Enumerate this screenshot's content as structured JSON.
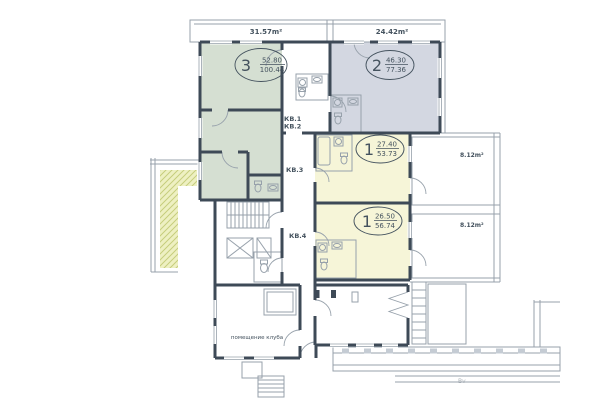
{
  "plan": {
    "watermark": "Bv",
    "terraces": {
      "left": "31.57m²",
      "right": "24.42m²"
    },
    "balconies": {
      "upper": "8.12m²",
      "lower": "8.12m²"
    },
    "units": {
      "kv1": "КВ.1",
      "kv2": "КВ.2",
      "kv3": "КВ.3",
      "kv4": "КВ.4"
    },
    "rooms": {
      "club": "помещение клуба"
    },
    "apartments": {
      "apt3": {
        "rooms": "3",
        "area1": "52.80",
        "area2": "100.44"
      },
      "apt2": {
        "rooms": "2",
        "area1": "46.30",
        "area2": "77.36"
      },
      "apt1a": {
        "rooms": "1",
        "area1": "27.40",
        "area2": "53.73"
      },
      "apt1b": {
        "rooms": "1",
        "area1": "26.50",
        "area2": "56.74"
      }
    },
    "colors": {
      "wall": "#3e4a57",
      "line": "#97a1ab",
      "apt3_fill": "#d5dfd2",
      "apt2_fill": "#d3d7e1",
      "apt1_fill": "#f6f5d8",
      "ramp_fill": "#eef0c2",
      "hatch": "#c6cd7c",
      "column_fill": "#c5ccd4",
      "text": "#44525e",
      "watermark": "#a9b0b7"
    }
  }
}
